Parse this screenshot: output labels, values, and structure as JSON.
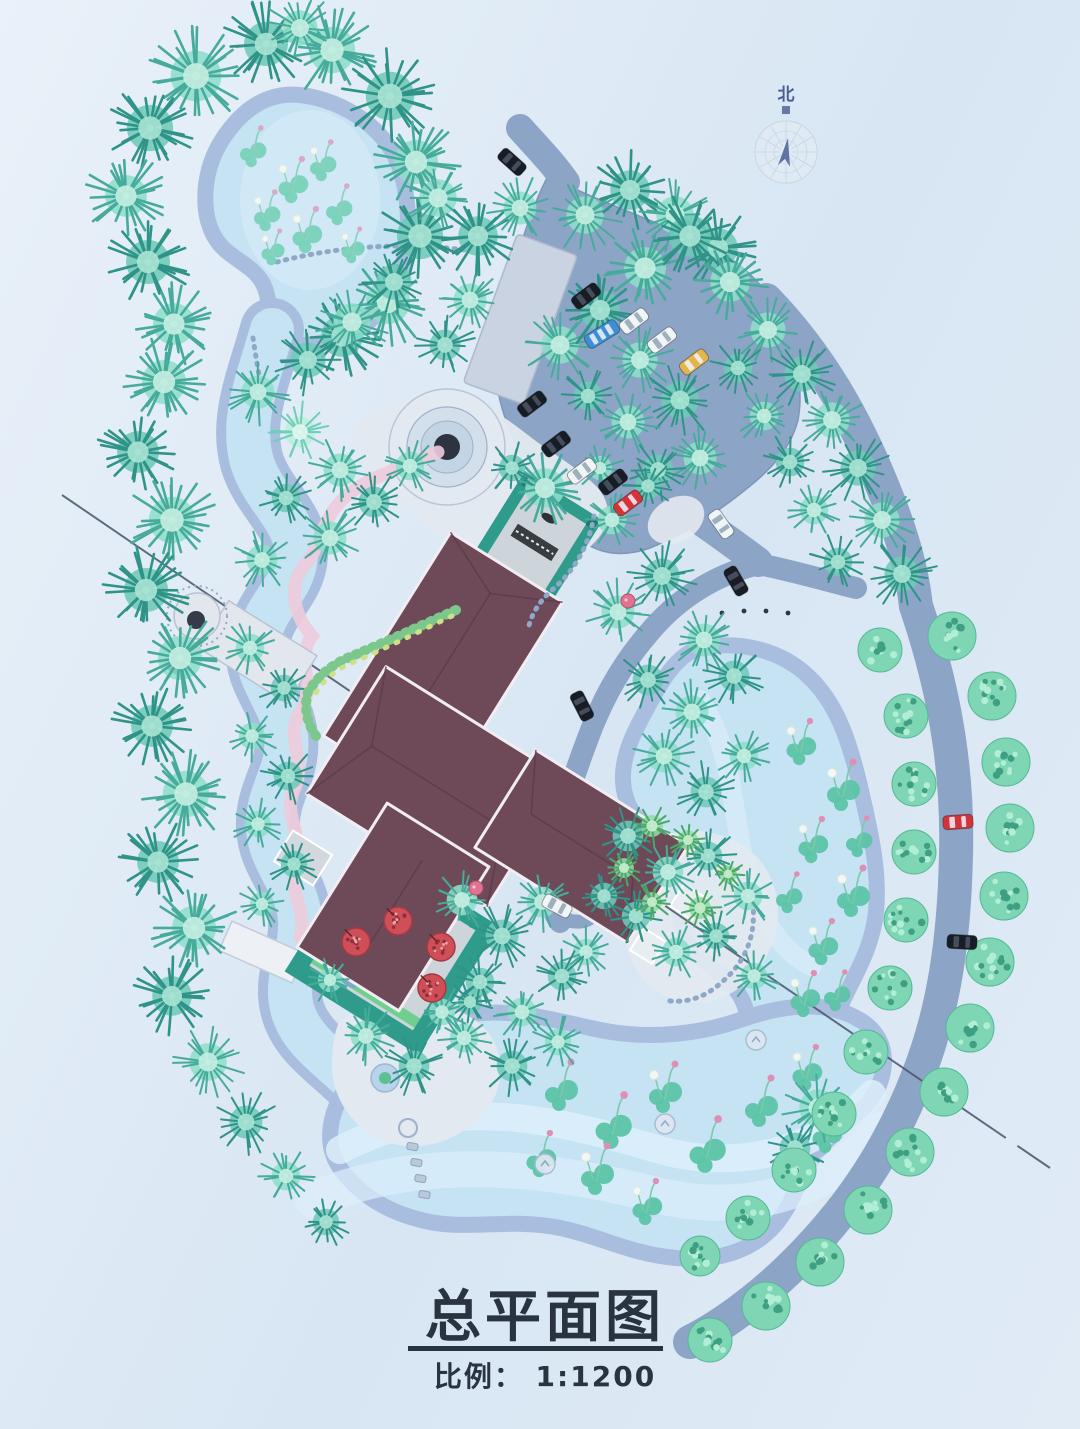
{
  "title_block": {
    "title": "总平面图",
    "scale_label": "比例： 1:1200"
  },
  "compass": {
    "label": "北"
  },
  "palette": {
    "water": "#c5e3f3",
    "waterlight": "#ddeefb",
    "shore": "#a9bedf",
    "road": "#8ca5c7",
    "roadedge": "#7d96b8",
    "pad": "#c9d3e1",
    "plaza": "#e3e9f0",
    "roof": "#6e4a59",
    "roofline": "#5a3a49",
    "outline": "#f1edf2",
    "courtyard": "#2f9c8b",
    "floor": "#cdd5db",
    "pergola": "#383d44",
    "hedge": "#7cc88c",
    "hedgelight": "#cfe08a",
    "pink": "#eecbdc",
    "ink": "#2a3340",
    "section": "#475569",
    "compass": "#4a5f94",
    "stone": "#dde7f1",
    "flower_red": "#cf4e57",
    "lotus_leaf": "#5cc4a6",
    "lotus_bud": "#e08fb4",
    "lotus_stem": "#7cc8ab",
    "bush_base": "#7fd6b4",
    "bush_dark": "#3f9f82",
    "bush_light": "#b2eed6",
    "car_black": "#181c24",
    "car_white": "#f2f5f7",
    "car_red": "#d5333a",
    "car_yellow": "#e4b54a",
    "car_blue": "#3e8ed6"
  },
  "tree_variants": [
    [
      "#bdeedd",
      "#6fcdb9",
      "#e2f8ef"
    ],
    [
      "#8fdec9",
      "#46ab9b",
      "#c6f0e3"
    ],
    [
      "#6fc9b8",
      "#2f9387",
      "#abe5d5"
    ],
    [
      "#93dba6",
      "#4aa968",
      "#cdeed2"
    ]
  ],
  "trees": [
    [
      196,
      76,
      46,
      1
    ],
    [
      266,
      44,
      40,
      2
    ],
    [
      332,
      50,
      42,
      1
    ],
    [
      390,
      96,
      44,
      2
    ],
    [
      416,
      162,
      40,
      1
    ],
    [
      420,
      236,
      42,
      2
    ],
    [
      388,
      302,
      40,
      1
    ],
    [
      342,
      336,
      38,
      2
    ],
    [
      150,
      128,
      42,
      2
    ],
    [
      126,
      196,
      38,
      1
    ],
    [
      148,
      262,
      40,
      2
    ],
    [
      174,
      324,
      38,
      1
    ],
    [
      300,
      28,
      32,
      1
    ],
    [
      164,
      382,
      40,
      1
    ],
    [
      138,
      452,
      38,
      2
    ],
    [
      172,
      520,
      42,
      1
    ],
    [
      146,
      590,
      40,
      2
    ],
    [
      180,
      658,
      40,
      1
    ],
    [
      152,
      726,
      38,
      2
    ],
    [
      186,
      794,
      42,
      1
    ],
    [
      158,
      862,
      38,
      2
    ],
    [
      194,
      928,
      40,
      1
    ],
    [
      172,
      996,
      36,
      2
    ],
    [
      208,
      1062,
      34,
      1
    ],
    [
      246,
      1122,
      30,
      2
    ],
    [
      286,
      1176,
      26,
      1
    ],
    [
      326,
      1222,
      24,
      2
    ],
    [
      258,
      392,
      30,
      1
    ],
    [
      308,
      360,
      32,
      2
    ],
    [
      352,
      322,
      34,
      1
    ],
    [
      394,
      282,
      32,
      2
    ],
    [
      300,
      432,
      28,
      0
    ],
    [
      340,
      470,
      30,
      1
    ],
    [
      286,
      498,
      26,
      2
    ],
    [
      330,
      538,
      30,
      1
    ],
    [
      374,
      502,
      28,
      2
    ],
    [
      410,
      466,
      26,
      1
    ],
    [
      262,
      560,
      28,
      1
    ],
    [
      250,
      648,
      26,
      1
    ],
    [
      284,
      688,
      24,
      2
    ],
    [
      252,
      736,
      24,
      1
    ],
    [
      288,
      776,
      26,
      2
    ],
    [
      258,
      824,
      24,
      1
    ],
    [
      294,
      864,
      24,
      2
    ],
    [
      262,
      904,
      22,
      1
    ],
    [
      330,
      980,
      22,
      1
    ],
    [
      438,
      198,
      34,
      1
    ],
    [
      478,
      236,
      36,
      2
    ],
    [
      520,
      208,
      30,
      1
    ],
    [
      585,
      215,
      34,
      1
    ],
    [
      630,
      190,
      36,
      2
    ],
    [
      675,
      215,
      34,
      1
    ],
    [
      718,
      248,
      36,
      2
    ],
    [
      470,
      300,
      30,
      1
    ],
    [
      445,
      345,
      28,
      2
    ],
    [
      560,
      345,
      34,
      1
    ],
    [
      600,
      310,
      36,
      2
    ],
    [
      645,
      268,
      38,
      1
    ],
    [
      690,
      236,
      38,
      2
    ],
    [
      730,
      282,
      36,
      1
    ],
    [
      640,
      360,
      32,
      1
    ],
    [
      680,
      400,
      34,
      2
    ],
    [
      628,
      422,
      30,
      1
    ],
    [
      588,
      396,
      26,
      2
    ],
    [
      700,
      458,
      30,
      1
    ],
    [
      658,
      470,
      28,
      2
    ],
    [
      768,
      330,
      32,
      1
    ],
    [
      802,
      374,
      32,
      2
    ],
    [
      832,
      420,
      32,
      1
    ],
    [
      858,
      468,
      32,
      2
    ],
    [
      882,
      520,
      32,
      1
    ],
    [
      902,
      574,
      32,
      2
    ],
    [
      738,
      368,
      26,
      2
    ],
    [
      764,
      416,
      26,
      1
    ],
    [
      790,
      462,
      26,
      2
    ],
    [
      814,
      510,
      26,
      1
    ],
    [
      838,
      562,
      26,
      2
    ],
    [
      618,
      612,
      30,
      1
    ],
    [
      662,
      576,
      32,
      2
    ],
    [
      704,
      640,
      30,
      1
    ],
    [
      648,
      680,
      28,
      2
    ],
    [
      692,
      712,
      30,
      1
    ],
    [
      734,
      676,
      28,
      2
    ],
    [
      664,
      756,
      30,
      1
    ],
    [
      706,
      792,
      28,
      2
    ],
    [
      744,
      756,
      26,
      1
    ],
    [
      628,
      836,
      28,
      2
    ],
    [
      668,
      872,
      28,
      1
    ],
    [
      708,
      856,
      26,
      2
    ],
    [
      748,
      896,
      26,
      1
    ],
    [
      636,
      916,
      26,
      2
    ],
    [
      676,
      952,
      26,
      1
    ],
    [
      716,
      936,
      24,
      2
    ],
    [
      754,
      976,
      24,
      1
    ],
    [
      604,
      896,
      24,
      2
    ],
    [
      586,
      952,
      24,
      1
    ],
    [
      612,
      520,
      26,
      1
    ],
    [
      648,
      486,
      24,
      2
    ],
    [
      600,
      468,
      22,
      1
    ],
    [
      366,
      1036,
      28,
      1
    ],
    [
      414,
      1066,
      28,
      2
    ],
    [
      464,
      1038,
      26,
      1
    ],
    [
      512,
      1066,
      28,
      2
    ],
    [
      558,
      1042,
      24,
      1
    ],
    [
      470,
      1002,
      22,
      2
    ],
    [
      462,
      900,
      28,
      1
    ],
    [
      502,
      936,
      30,
      2
    ],
    [
      542,
      902,
      28,
      1
    ],
    [
      480,
      982,
      26,
      2
    ],
    [
      522,
      1012,
      26,
      1
    ],
    [
      562,
      976,
      26,
      2
    ],
    [
      442,
      1012,
      24,
      1
    ],
    [
      652,
      826,
      20,
      3
    ],
    [
      624,
      868,
      18,
      3
    ],
    [
      688,
      840,
      18,
      3
    ],
    [
      700,
      908,
      20,
      3
    ],
    [
      652,
      902,
      18,
      3
    ],
    [
      728,
      874,
      16,
      3
    ],
    [
      818,
      1108,
      34,
      1
    ],
    [
      795,
      1148,
      28,
      2
    ],
    [
      545,
      488,
      36,
      1
    ],
    [
      512,
      468,
      24,
      2
    ]
  ],
  "bushes": [
    [
      952,
      636,
      24
    ],
    [
      992,
      696,
      24
    ],
    [
      1006,
      762,
      24
    ],
    [
      1010,
      828,
      24
    ],
    [
      1004,
      896,
      24
    ],
    [
      990,
      962,
      24
    ],
    [
      970,
      1028,
      24
    ],
    [
      944,
      1092,
      24
    ],
    [
      910,
      1152,
      24
    ],
    [
      868,
      1210,
      24
    ],
    [
      820,
      1262,
      24
    ],
    [
      766,
      1306,
      24
    ],
    [
      710,
      1340,
      22
    ],
    [
      880,
      650,
      22
    ],
    [
      906,
      716,
      22
    ],
    [
      914,
      784,
      22
    ],
    [
      914,
      852,
      22
    ],
    [
      906,
      920,
      22
    ],
    [
      890,
      988,
      22
    ],
    [
      866,
      1052,
      22
    ],
    [
      834,
      1114,
      22
    ],
    [
      794,
      1170,
      22
    ],
    [
      748,
      1218,
      22
    ],
    [
      700,
      1256,
      20
    ]
  ],
  "lotus": [
    [
      560,
      1092,
      1
    ],
    [
      612,
      1128,
      1.1
    ],
    [
      664,
      1094,
      1
    ],
    [
      706,
      1152,
      1.1
    ],
    [
      596,
      1176,
      1
    ],
    [
      646,
      1208,
      0.9
    ],
    [
      540,
      1160,
      0.9
    ],
    [
      760,
      1108,
      1
    ],
    [
      806,
      1074,
      0.9
    ],
    [
      826,
      1136,
      0.9
    ],
    [
      800,
      748,
      0.9
    ],
    [
      842,
      792,
      1
    ],
    [
      812,
      846,
      0.9
    ],
    [
      852,
      898,
      1
    ],
    [
      822,
      948,
      0.9
    ],
    [
      788,
      898,
      0.8
    ],
    [
      858,
      842,
      0.8
    ],
    [
      804,
      1000,
      0.9
    ],
    [
      836,
      996,
      0.8
    ]
  ],
  "pond_plants": [
    [
      252,
      152,
      0.8
    ],
    [
      292,
      186,
      0.9
    ],
    [
      266,
      216,
      0.8
    ],
    [
      322,
      166,
      0.8
    ],
    [
      306,
      236,
      0.9
    ],
    [
      272,
      252,
      0.7
    ],
    [
      338,
      210,
      0.8
    ],
    [
      352,
      250,
      0.7
    ]
  ],
  "flower_trees": [
    [
      356,
      942,
      14
    ],
    [
      398,
      921,
      14
    ],
    [
      441,
      947,
      14
    ],
    [
      432,
      988,
      14
    ]
  ],
  "mini_flowers": [
    [
      628,
      601,
      7
    ],
    [
      476,
      888,
      7
    ]
  ],
  "stone_icons": [
    [
      665,
      1124
    ],
    [
      756,
      1040
    ],
    [
      545,
      1164
    ]
  ],
  "cars": [
    {
      "color": "car_black",
      "x": 586,
      "y": 296,
      "a": -37
    },
    {
      "color": "car_white",
      "x": 634,
      "y": 321,
      "a": -37
    },
    {
      "color": "car_white",
      "x": 662,
      "y": 340,
      "a": -37
    },
    {
      "color": "car_yellow",
      "x": 694,
      "y": 362,
      "a": -37
    },
    {
      "color": "car_blue",
      "x": 602,
      "y": 334,
      "a": -32,
      "type": "bus"
    },
    {
      "color": "car_black",
      "x": 532,
      "y": 404,
      "a": -37
    },
    {
      "color": "car_black",
      "x": 556,
      "y": 444,
      "a": -37
    },
    {
      "color": "car_white",
      "x": 582,
      "y": 471,
      "a": -37
    },
    {
      "color": "car_black",
      "x": 613,
      "y": 482,
      "a": -37
    },
    {
      "color": "car_red",
      "x": 628,
      "y": 503,
      "a": -37
    },
    {
      "color": "car_black",
      "x": 512,
      "y": 162,
      "a": 42
    },
    {
      "color": "car_white",
      "x": 721,
      "y": 524,
      "a": 55
    },
    {
      "color": "car_black",
      "x": 736,
      "y": 581,
      "a": 60
    },
    {
      "color": "car_black",
      "x": 582,
      "y": 706,
      "a": 63
    },
    {
      "color": "car_white",
      "x": 557,
      "y": 906,
      "a": 28
    },
    {
      "color": "car_red",
      "x": 958,
      "y": 822,
      "a": -4
    },
    {
      "color": "car_black",
      "x": 962,
      "y": 942,
      "a": 3
    }
  ]
}
